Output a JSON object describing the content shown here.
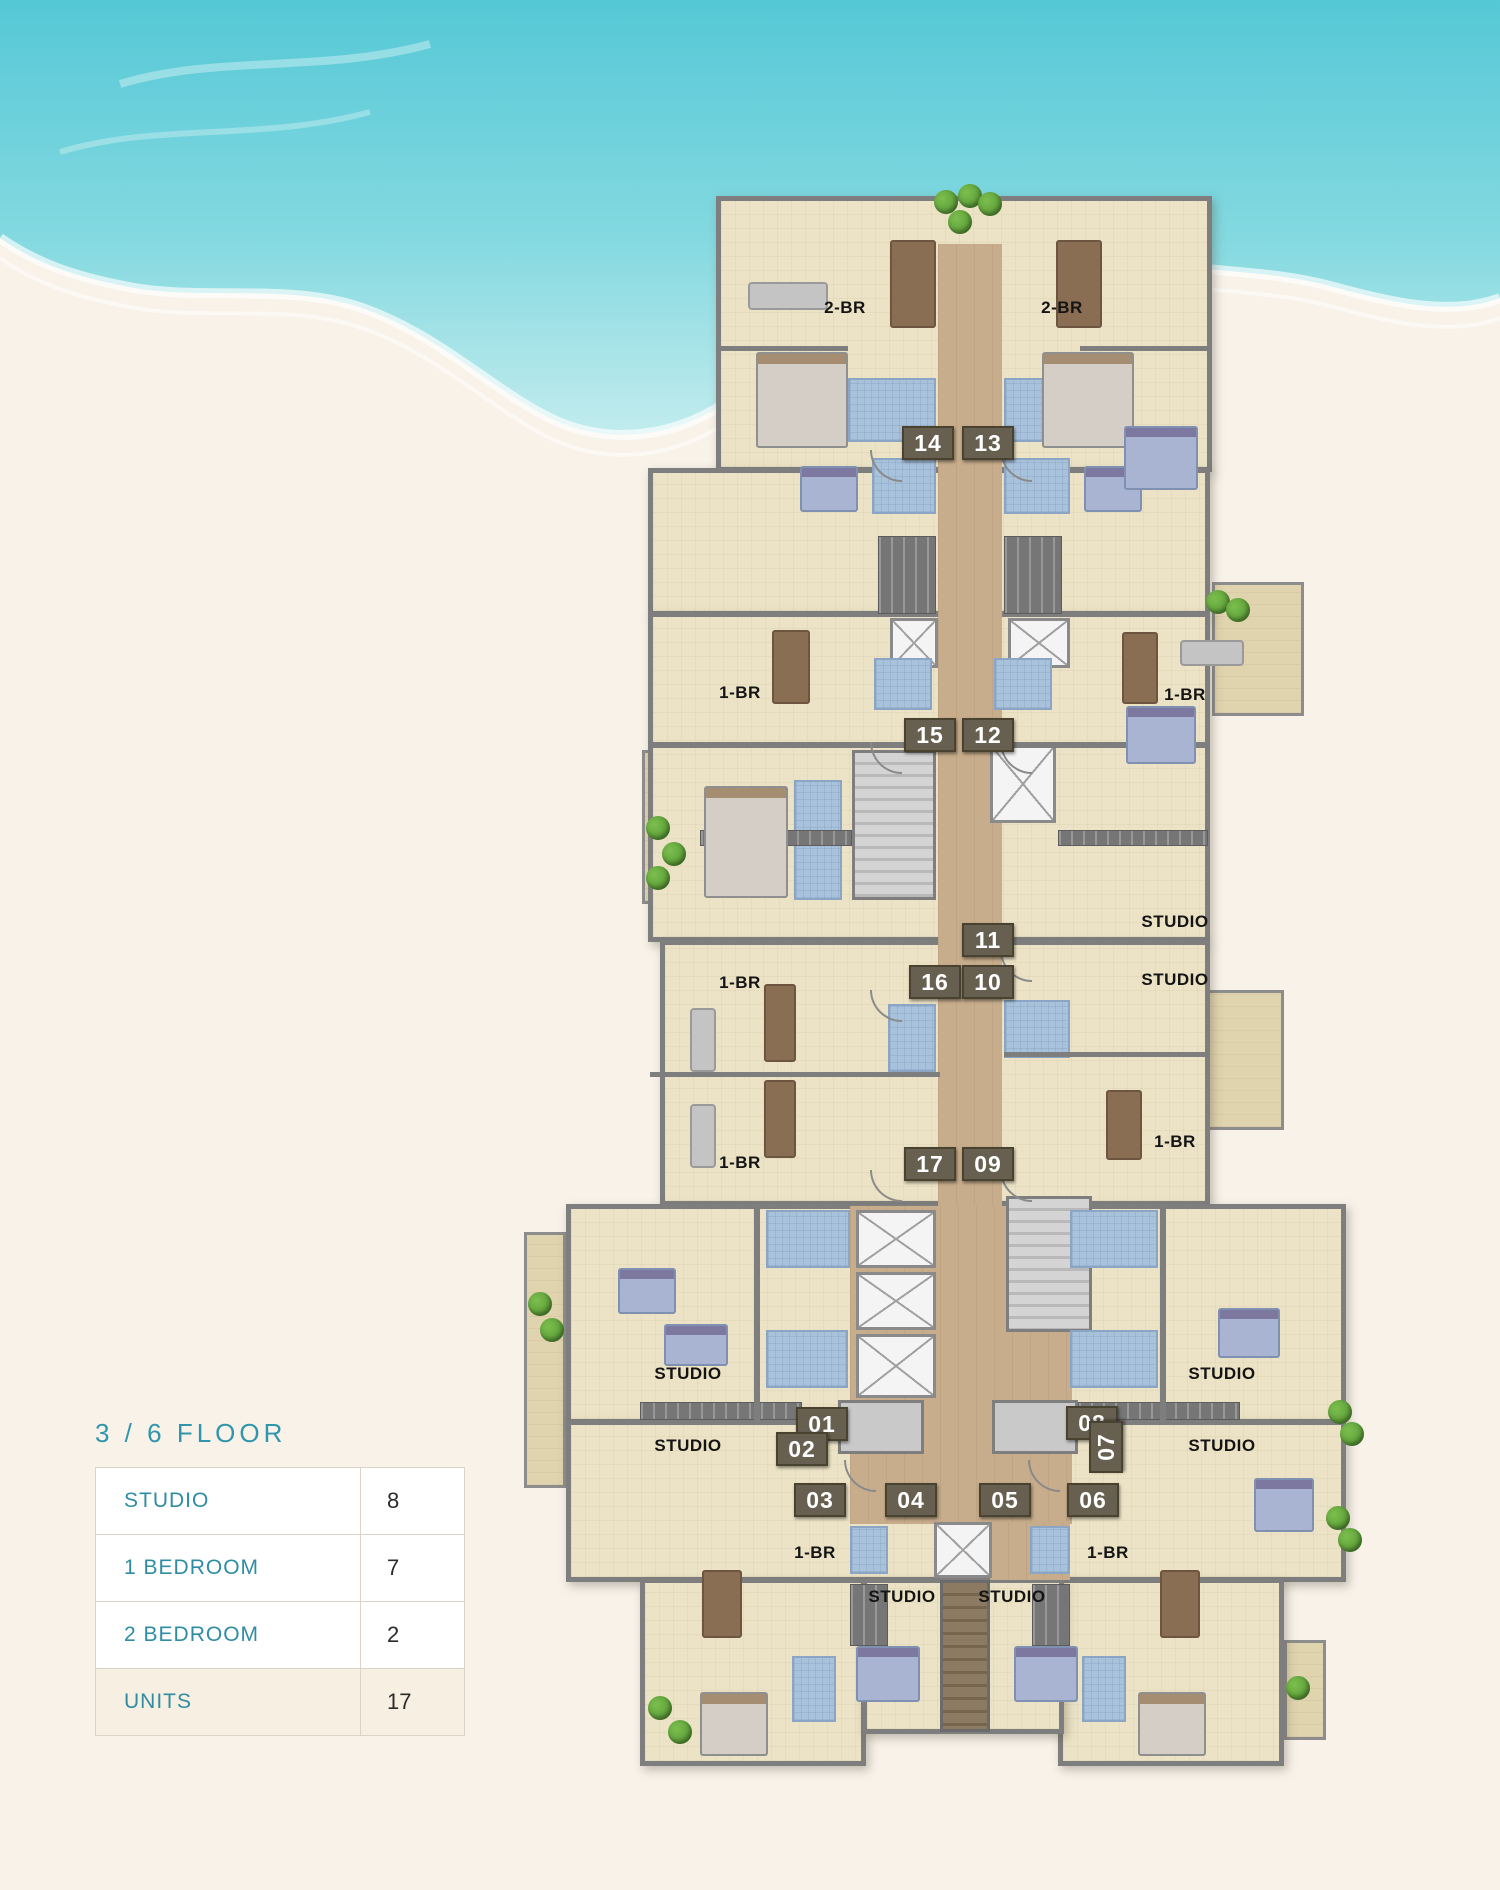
{
  "legend": {
    "title": "3 / 6  FLOOR",
    "rows": [
      {
        "label": "STUDIO",
        "value": "8"
      },
      {
        "label": "1 BEDROOM",
        "value": "7"
      },
      {
        "label": "2 BEDROOM",
        "value": "2"
      },
      {
        "label": "UNITS",
        "value": "17"
      }
    ]
  },
  "colors": {
    "page_sand": "#f8f2e9",
    "sea_deep": "#55c8d6",
    "sea_light": "#a8e4e8",
    "accent_teal": "#2f96ac",
    "floor_beige": "#ece3c6",
    "terrace_beige": "#e0d4ae",
    "corridor_tan": "#c7ad8c",
    "wall_gray": "#7e7e7e",
    "bath_blue": "#a9c2dc",
    "badge_brown": "#675f50",
    "highlight_row": "#f7efe1",
    "tree_green": "#4e8f2e"
  },
  "plan": {
    "rooms": [
      {
        "x": 716,
        "y": 196,
        "w": 496,
        "h": 276
      },
      {
        "x": 648,
        "y": 468,
        "w": 562,
        "h": 148
      },
      {
        "x": 648,
        "y": 612,
        "w": 562,
        "h": 330
      },
      {
        "x": 660,
        "y": 940,
        "w": 550,
        "h": 266
      },
      {
        "x": 566,
        "y": 1204,
        "w": 780,
        "h": 220
      },
      {
        "x": 566,
        "y": 1420,
        "w": 780,
        "h": 162
      },
      {
        "x": 640,
        "y": 1578,
        "w": 226,
        "h": 188
      },
      {
        "x": 1058,
        "y": 1578,
        "w": 226,
        "h": 188
      },
      {
        "x": 862,
        "y": 1578,
        "w": 202,
        "h": 156
      }
    ],
    "terraces": [
      {
        "x": 904,
        "y": 200,
        "w": 304,
        "h": 48
      },
      {
        "x": 1212,
        "y": 582,
        "w": 92,
        "h": 134
      },
      {
        "x": 642,
        "y": 750,
        "w": 48,
        "h": 154
      },
      {
        "x": 1206,
        "y": 990,
        "w": 78,
        "h": 140
      },
      {
        "x": 524,
        "y": 1232,
        "w": 42,
        "h": 256
      },
      {
        "x": 1304,
        "y": 1354,
        "w": 40,
        "h": 224
      },
      {
        "x": 642,
        "y": 1652,
        "w": 46,
        "h": 110
      },
      {
        "x": 1284,
        "y": 1640,
        "w": 42,
        "h": 100
      }
    ],
    "corridors": [
      {
        "x": 938,
        "y": 244,
        "w": 64,
        "h": 964
      },
      {
        "x": 850,
        "y": 1206,
        "w": 222,
        "h": 318
      },
      {
        "x": 990,
        "y": 1522,
        "w": 80,
        "h": 58
      }
    ],
    "stairs": [
      {
        "x": 852,
        "y": 750,
        "w": 84,
        "h": 150
      },
      {
        "x": 1006,
        "y": 1196,
        "w": 86,
        "h": 136
      }
    ],
    "stairs_brown": [
      {
        "x": 940,
        "y": 1580,
        "w": 50,
        "h": 152
      }
    ],
    "elevators_x": [
      {
        "x": 990,
        "y": 745,
        "w": 66,
        "h": 78
      },
      {
        "x": 890,
        "y": 618,
        "w": 48,
        "h": 50
      },
      {
        "x": 1008,
        "y": 618,
        "w": 62,
        "h": 50
      },
      {
        "x": 856,
        "y": 1210,
        "w": 80,
        "h": 58
      },
      {
        "x": 856,
        "y": 1272,
        "w": 80,
        "h": 58
      },
      {
        "x": 856,
        "y": 1334,
        "w": 80,
        "h": 64
      },
      {
        "x": 934,
        "y": 1522,
        "w": 58,
        "h": 56
      }
    ],
    "elevators_gray": [
      {
        "x": 838,
        "y": 1400,
        "w": 86,
        "h": 54
      },
      {
        "x": 992,
        "y": 1400,
        "w": 86,
        "h": 54
      }
    ],
    "bathrooms": [
      {
        "x": 848,
        "y": 378,
        "w": 88,
        "h": 64
      },
      {
        "x": 1004,
        "y": 378,
        "w": 90,
        "h": 64
      },
      {
        "x": 872,
        "y": 458,
        "w": 64,
        "h": 56
      },
      {
        "x": 1004,
        "y": 458,
        "w": 66,
        "h": 56
      },
      {
        "x": 874,
        "y": 658,
        "w": 58,
        "h": 52
      },
      {
        "x": 994,
        "y": 658,
        "w": 58,
        "h": 52
      },
      {
        "x": 794,
        "y": 780,
        "w": 48,
        "h": 120
      },
      {
        "x": 888,
        "y": 1004,
        "w": 48,
        "h": 68
      },
      {
        "x": 1004,
        "y": 1000,
        "w": 66,
        "h": 58
      },
      {
        "x": 766,
        "y": 1210,
        "w": 84,
        "h": 58
      },
      {
        "x": 1070,
        "y": 1210,
        "w": 88,
        "h": 58
      },
      {
        "x": 766,
        "y": 1330,
        "w": 82,
        "h": 58
      },
      {
        "x": 1070,
        "y": 1330,
        "w": 88,
        "h": 58
      },
      {
        "x": 850,
        "y": 1526,
        "w": 38,
        "h": 48
      },
      {
        "x": 1030,
        "y": 1526,
        "w": 40,
        "h": 48
      },
      {
        "x": 792,
        "y": 1656,
        "w": 44,
        "h": 66
      },
      {
        "x": 1082,
        "y": 1656,
        "w": 44,
        "h": 66
      }
    ],
    "kitchens": [
      {
        "x": 878,
        "y": 536,
        "w": 58,
        "h": 78
      },
      {
        "x": 1004,
        "y": 536,
        "w": 58,
        "h": 78
      },
      {
        "x": 700,
        "y": 830,
        "w": 152,
        "h": 16
      },
      {
        "x": 1058,
        "y": 830,
        "w": 150,
        "h": 16
      },
      {
        "x": 640,
        "y": 1402,
        "w": 162,
        "h": 18
      },
      {
        "x": 1078,
        "y": 1402,
        "w": 162,
        "h": 18
      },
      {
        "x": 850,
        "y": 1584,
        "w": 38,
        "h": 62
      },
      {
        "x": 1032,
        "y": 1584,
        "w": 38,
        "h": 62
      }
    ],
    "walls": [
      {
        "x": 648,
        "y": 742,
        "w": 290,
        "h": 6
      },
      {
        "x": 1002,
        "y": 742,
        "w": 208,
        "h": 6
      },
      {
        "x": 650,
        "y": 1072,
        "w": 290,
        "h": 5
      },
      {
        "x": 1004,
        "y": 1052,
        "w": 206,
        "h": 5
      },
      {
        "x": 716,
        "y": 346,
        "w": 132,
        "h": 5
      },
      {
        "x": 1080,
        "y": 346,
        "w": 132,
        "h": 5
      },
      {
        "x": 754,
        "y": 1204,
        "w": 6,
        "h": 218
      },
      {
        "x": 1160,
        "y": 1204,
        "w": 6,
        "h": 218
      }
    ],
    "furniture": [
      {
        "cls": "bed",
        "x": 756,
        "y": 352,
        "w": 92,
        "h": 96
      },
      {
        "cls": "bed",
        "x": 1042,
        "y": 352,
        "w": 92,
        "h": 96
      },
      {
        "cls": "bed",
        "x": 704,
        "y": 786,
        "w": 84,
        "h": 112
      },
      {
        "cls": "bed",
        "x": 700,
        "y": 1692,
        "w": 68,
        "h": 64
      },
      {
        "cls": "bed",
        "x": 1138,
        "y": 1692,
        "w": 68,
        "h": 64
      },
      {
        "cls": "bed-blue",
        "x": 800,
        "y": 466,
        "w": 58,
        "h": 46
      },
      {
        "cls": "bed-blue",
        "x": 1084,
        "y": 466,
        "w": 58,
        "h": 46
      },
      {
        "cls": "bed-blue",
        "x": 1124,
        "y": 426,
        "w": 74,
        "h": 64
      },
      {
        "cls": "bed-blue",
        "x": 1126,
        "y": 706,
        "w": 70,
        "h": 58
      },
      {
        "cls": "bed-blue",
        "x": 1218,
        "y": 1308,
        "w": 62,
        "h": 50
      },
      {
        "cls": "bed-blue",
        "x": 1254,
        "y": 1478,
        "w": 60,
        "h": 54
      },
      {
        "cls": "bed-blue",
        "x": 664,
        "y": 1324,
        "w": 64,
        "h": 42
      },
      {
        "cls": "bed-blue",
        "x": 618,
        "y": 1268,
        "w": 58,
        "h": 46
      },
      {
        "cls": "bed-blue",
        "x": 856,
        "y": 1646,
        "w": 64,
        "h": 56
      },
      {
        "cls": "bed-blue",
        "x": 1014,
        "y": 1646,
        "w": 64,
        "h": 56
      },
      {
        "cls": "table-brown",
        "x": 890,
        "y": 240,
        "w": 46,
        "h": 88
      },
      {
        "cls": "table-brown",
        "x": 1056,
        "y": 240,
        "w": 46,
        "h": 88
      },
      {
        "cls": "table-brown",
        "x": 764,
        "y": 984,
        "w": 32,
        "h": 78
      },
      {
        "cls": "table-brown",
        "x": 764,
        "y": 1080,
        "w": 32,
        "h": 78
      },
      {
        "cls": "table-brown",
        "x": 1106,
        "y": 1090,
        "w": 36,
        "h": 70
      },
      {
        "cls": "table-brown",
        "x": 772,
        "y": 630,
        "w": 38,
        "h": 74
      },
      {
        "cls": "table-brown",
        "x": 1122,
        "y": 632,
        "w": 36,
        "h": 72
      },
      {
        "cls": "table-brown",
        "x": 702,
        "y": 1570,
        "w": 40,
        "h": 68
      },
      {
        "cls": "table-brown",
        "x": 1160,
        "y": 1570,
        "w": 40,
        "h": 68
      },
      {
        "cls": "sofa",
        "x": 748,
        "y": 282,
        "w": 80,
        "h": 28
      },
      {
        "cls": "sofa",
        "x": 1180,
        "y": 640,
        "w": 64,
        "h": 26
      },
      {
        "cls": "sofa",
        "x": 690,
        "y": 1008,
        "w": 26,
        "h": 64
      },
      {
        "cls": "sofa",
        "x": 690,
        "y": 1104,
        "w": 26,
        "h": 64
      },
      {
        "cls": "door",
        "x": 870,
        "y": 450
      },
      {
        "cls": "door",
        "x": 1000,
        "y": 450
      },
      {
        "cls": "door",
        "x": 870,
        "y": 742
      },
      {
        "cls": "door",
        "x": 1000,
        "y": 742
      },
      {
        "cls": "door",
        "x": 1000,
        "y": 950
      },
      {
        "cls": "door",
        "x": 870,
        "y": 990
      },
      {
        "cls": "door",
        "x": 870,
        "y": 1170
      },
      {
        "cls": "door",
        "x": 1000,
        "y": 1170
      },
      {
        "cls": "door",
        "x": 844,
        "y": 1460
      },
      {
        "cls": "door",
        "x": 1028,
        "y": 1460
      }
    ],
    "trees": [
      {
        "x": 934,
        "y": 190
      },
      {
        "x": 958,
        "y": 184
      },
      {
        "x": 948,
        "y": 210
      },
      {
        "x": 978,
        "y": 192
      },
      {
        "x": 1206,
        "y": 590
      },
      {
        "x": 1226,
        "y": 598
      },
      {
        "x": 646,
        "y": 816
      },
      {
        "x": 662,
        "y": 842
      },
      {
        "x": 646,
        "y": 866
      },
      {
        "x": 528,
        "y": 1292
      },
      {
        "x": 540,
        "y": 1318
      },
      {
        "x": 648,
        "y": 1696
      },
      {
        "x": 668,
        "y": 1720
      },
      {
        "x": 1328,
        "y": 1400
      },
      {
        "x": 1340,
        "y": 1422
      },
      {
        "x": 1326,
        "y": 1506
      },
      {
        "x": 1338,
        "y": 1528
      },
      {
        "x": 1286,
        "y": 1676
      }
    ],
    "unit_badges": [
      {
        "text": "14",
        "x": 902,
        "y": 426
      },
      {
        "text": "13",
        "x": 962,
        "y": 426
      },
      {
        "text": "15",
        "x": 904,
        "y": 718
      },
      {
        "text": "12",
        "x": 962,
        "y": 718
      },
      {
        "text": "11",
        "x": 962,
        "y": 923
      },
      {
        "text": "16",
        "x": 909,
        "y": 965
      },
      {
        "text": "10",
        "x": 962,
        "y": 965
      },
      {
        "text": "17",
        "x": 904,
        "y": 1147
      },
      {
        "text": "09",
        "x": 962,
        "y": 1147
      },
      {
        "text": "01",
        "x": 796,
        "y": 1407
      },
      {
        "text": "08",
        "x": 1066,
        "y": 1406
      },
      {
        "text": "02",
        "x": 776,
        "y": 1432
      },
      {
        "text": "07",
        "x": 1080,
        "y": 1430,
        "rot": -90
      },
      {
        "text": "03",
        "x": 794,
        "y": 1483
      },
      {
        "text": "04",
        "x": 885,
        "y": 1483
      },
      {
        "text": "05",
        "x": 979,
        "y": 1483
      },
      {
        "text": "06",
        "x": 1067,
        "y": 1483
      }
    ],
    "room_labels": [
      {
        "text": "2-BR",
        "x": 800,
        "y": 298
      },
      {
        "text": "2-BR",
        "x": 1017,
        "y": 298
      },
      {
        "text": "1-BR",
        "x": 695,
        "y": 683
      },
      {
        "text": "1-BR",
        "x": 1140,
        "y": 685
      },
      {
        "text": "1-BR",
        "x": 695,
        "y": 973
      },
      {
        "text": "1-BR",
        "x": 695,
        "y": 1153
      },
      {
        "text": "STUDIO",
        "x": 1130,
        "y": 912
      },
      {
        "text": "STUDIO",
        "x": 1130,
        "y": 970
      },
      {
        "text": "1-BR",
        "x": 1130,
        "y": 1132
      },
      {
        "text": "STUDIO",
        "x": 643,
        "y": 1364
      },
      {
        "text": "STUDIO",
        "x": 643,
        "y": 1436
      },
      {
        "text": "STUDIO",
        "x": 1177,
        "y": 1364
      },
      {
        "text": "STUDIO",
        "x": 1177,
        "y": 1436
      },
      {
        "text": "1-BR",
        "x": 770,
        "y": 1543
      },
      {
        "text": "1-BR",
        "x": 1063,
        "y": 1543
      },
      {
        "text": "STUDIO",
        "x": 857,
        "y": 1587
      },
      {
        "text": "STUDIO",
        "x": 967,
        "y": 1587
      }
    ]
  }
}
